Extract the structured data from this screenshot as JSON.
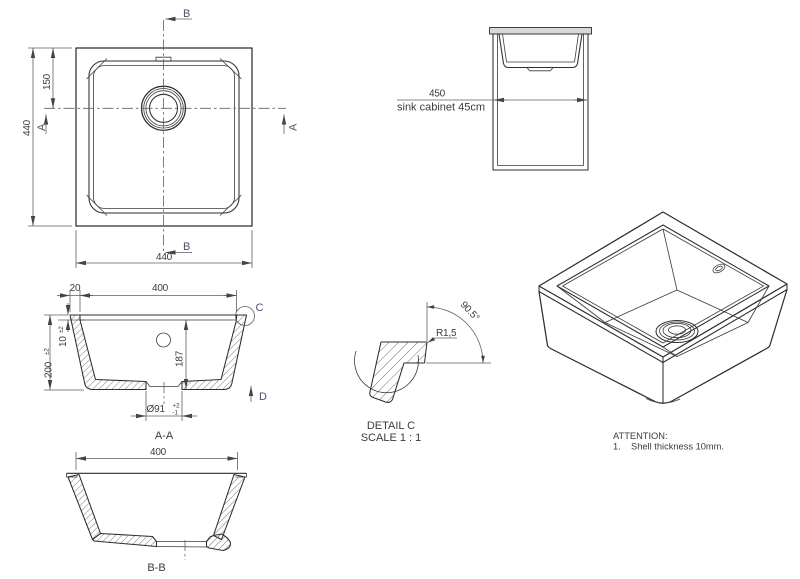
{
  "top_view": {
    "dim_height": "440",
    "dim_drain_offset": "150",
    "dim_width": "440",
    "label_a": "A",
    "label_b": "B"
  },
  "cabinet_view": {
    "dim_width": "450",
    "caption": "sink cabinet 45cm"
  },
  "section_aa": {
    "dim_rim": "20",
    "dim_width": "400",
    "dim_depth": "200",
    "depth_tol": "±2",
    "dim_shell": "10",
    "shell_tol": "±2",
    "dim_inner_depth": "187",
    "dim_drain": "Ø91",
    "drain_tol_plus": "+2",
    "drain_tol_minus": "-1",
    "title": "A-A",
    "label_c": "C",
    "label_d": "D"
  },
  "section_bb": {
    "dim_width": "400",
    "title": "B-B"
  },
  "detail_c": {
    "title": "DETAIL C",
    "scale": "SCALE 1 : 1",
    "radius": "R1,5",
    "angle": "90.5°"
  },
  "attention": {
    "title": "ATTENTION:",
    "item_number": "1.",
    "item_text": "Shell thickness 10mm."
  },
  "colors": {
    "object_line": "#2e2e2e",
    "dimension_line": "#5f5f5f",
    "section_label": "#47536e",
    "text": "#3b3b3b",
    "countertop_fill": "#d8d8d8"
  }
}
